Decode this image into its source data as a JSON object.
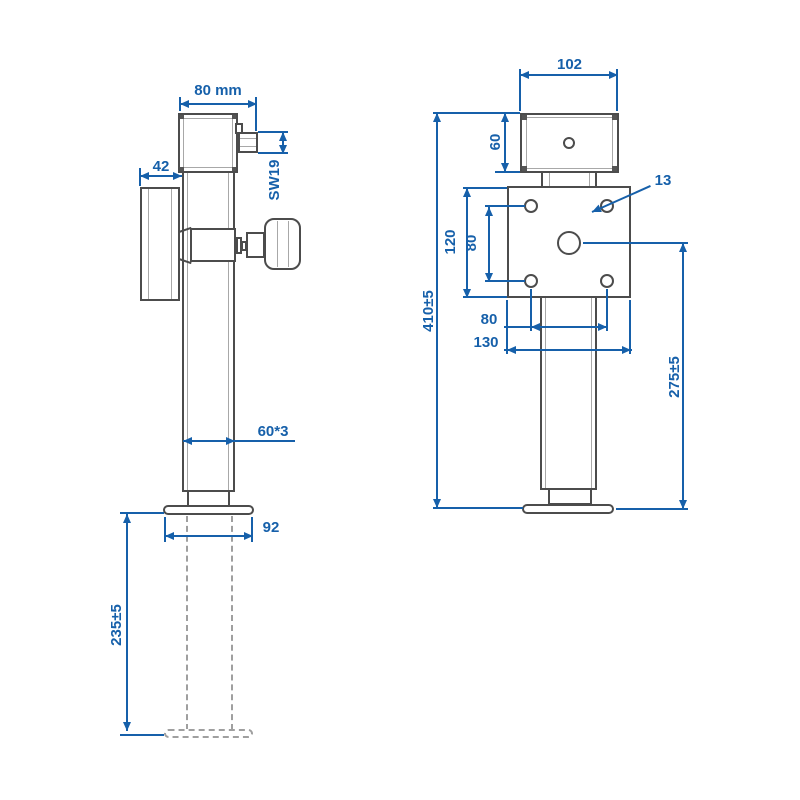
{
  "drawing": {
    "type": "technical-dimension-drawing",
    "subject": "trailer drop-leg jack with crank handle and mounting plate, two orthographic views",
    "colors": {
      "dimension_accent": "#1660aa",
      "part_outline": "#4c4c4c"
    },
    "side_view": {
      "name": "side view (left)",
      "dims": {
        "overall_width": "80 mm",
        "bracket_offset": "42",
        "hex_drive": "SW19",
        "tube_section": "60*3",
        "foot_width": "92",
        "drop_leg_extension": "235±5"
      }
    },
    "front_view": {
      "name": "front view (right)",
      "dims": {
        "gearbox_width": "102",
        "gearbox_height": "60",
        "hole_diameter": "13",
        "plate_height": "120",
        "hole_spacing_vertical": "80",
        "hole_spacing_horizontal": "80",
        "plate_width": "130",
        "overall_height": "410±5",
        "center_to_foot": "275±5"
      }
    }
  }
}
